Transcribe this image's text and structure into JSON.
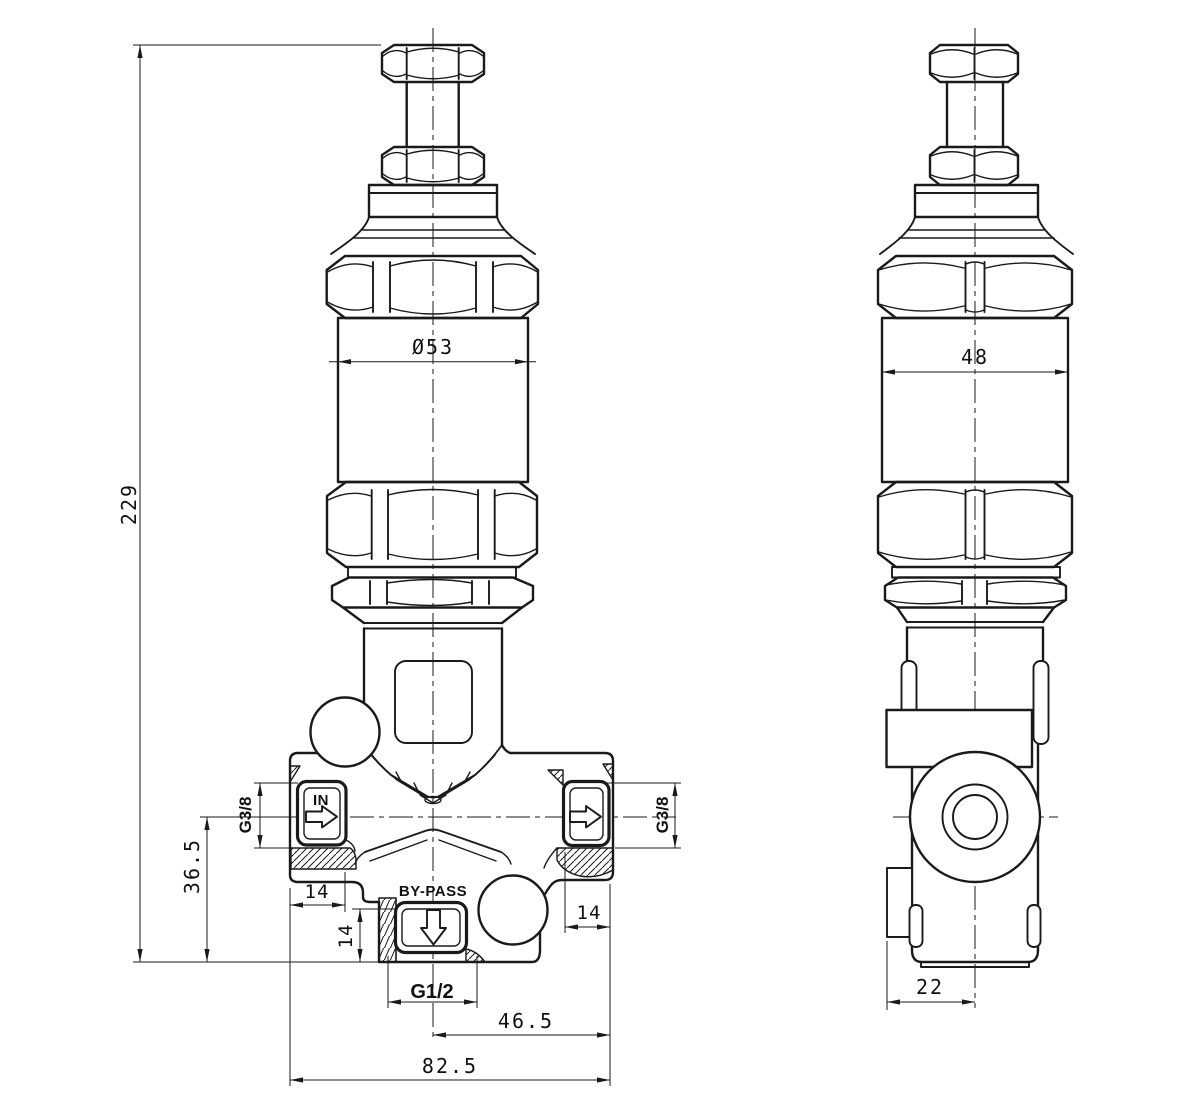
{
  "colors": {
    "line": "#1a1a1a",
    "background": "#ffffff"
  },
  "front_view": {
    "overall_height": "229",
    "head_diameter": "Ø53",
    "inlet_label": "IN",
    "inlet_thread": "G3/8",
    "outlet_thread": "G3/8",
    "axis_height": "36.5",
    "inlet_port_depth": "14",
    "bypass_port_depth": "14",
    "outlet_port_depth": "14",
    "bypass_label": "BY-PASS",
    "bypass_thread": "G1/2",
    "axis_to_right_edge": "46.5",
    "body_width": "82.5"
  },
  "side_view": {
    "width_across_flats": "48",
    "flange_to_axis": "22"
  }
}
